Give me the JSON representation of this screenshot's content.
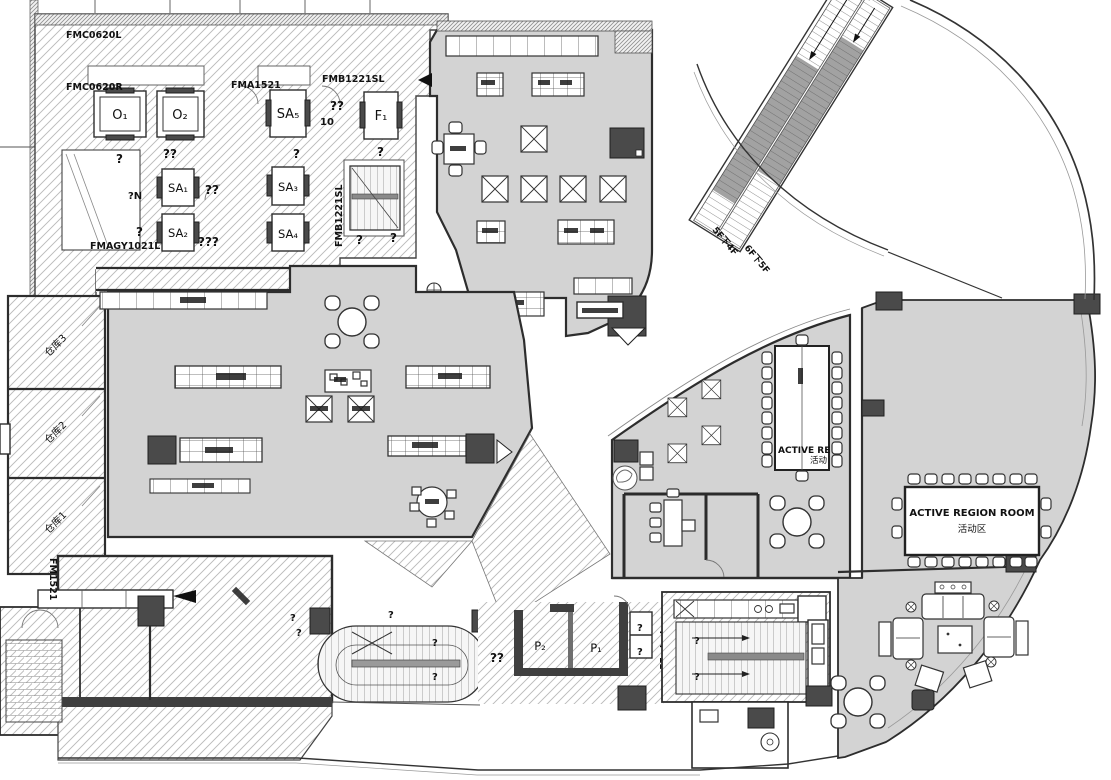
{
  "plan": {
    "type": "architectural-floor-plan",
    "colors": {
      "room_fill": "#d3d3d3",
      "wall": "#2d2d2d",
      "dark_block": "#4a4a4a",
      "hatch_line": "#b6b6b6"
    },
    "codes": {
      "fmc0620l": "FMC0620L",
      "fmc0620r": "FMC0620R",
      "fma1521": "FMA1521",
      "fmb1221sl_top": "FMB1221SL",
      "fmb1221sl_side": "FMB1221SL",
      "fmagy1021l": "FMAGY1021L",
      "fm1521": "FM1521"
    },
    "rooms": {
      "o1": "O₁",
      "o2": "O₂",
      "sa5": "SA₅",
      "f1": "F₁",
      "sa1": "SA₁",
      "sa2": "SA₂",
      "sa3": "SA₃",
      "sa4": "SA₄",
      "p2": "P₂",
      "p1": "P₁"
    },
    "storage": {
      "room3": "仓库3",
      "room2": "仓库2",
      "room1": "仓库1"
    },
    "escalator": {
      "upper": "5F下4F",
      "lower": "6F下5F"
    },
    "active_region_room": {
      "title": "ACTIVE REGION ROOM",
      "subtitle": "活动区"
    },
    "craft_table": {
      "title": "ACTIVE RE",
      "subtitle": "活动"
    },
    "dimensions": {
      "left": "1500"
    },
    "marks": {
      "q": "?",
      "qq": "??",
      "qqq": "???",
      "qn": "?N",
      "ten": "10",
      "i1": "11"
    }
  }
}
